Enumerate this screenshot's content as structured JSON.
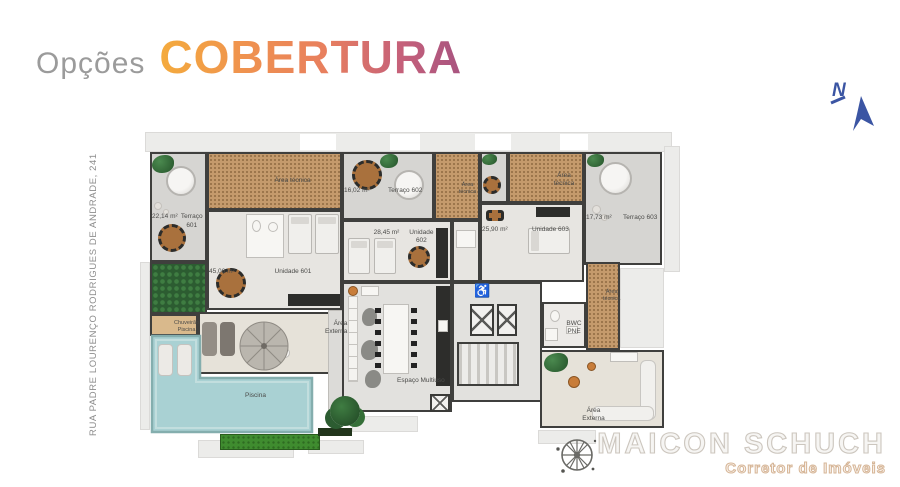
{
  "header": {
    "prefix": "Opções",
    "title": "COBERTURA"
  },
  "address": "RUA PADRE LOURENÇO RODRIGUES DE ANDRADE, 241",
  "compass": {
    "label": "N"
  },
  "branding": {
    "name": "MAICON SCHUCH",
    "tagline": "Corretor de Imóveis"
  },
  "icons": {
    "wheelchair": "♿"
  },
  "colors": {
    "title_gradient_start": "#f4ab3d",
    "title_gradient_end": "#a85480",
    "prefix_gray": "#9b9b9b",
    "compass_blue": "#3b55a3",
    "technical_floor": "#c49a6c",
    "terrace_floor": "#d6d5d2",
    "unit_floor": "#e7e5e1",
    "pool_water": "#a9d1d3",
    "grass_green": "#3f8c2f",
    "wall": "#3f3f3d"
  },
  "plan": {
    "rooms": [
      {
        "id": "terraco-601",
        "name": "Terraço 601",
        "area": "22,14 m²"
      },
      {
        "id": "area-tecnica-1",
        "name": "Área técnica"
      },
      {
        "id": "terraco-602",
        "name": "Terraço 602",
        "area": "16,02 m²"
      },
      {
        "id": "area-tecnica-2",
        "name": "Área técnica"
      },
      {
        "id": "area-tecnica-3",
        "name": "Área técnica"
      },
      {
        "id": "terraco-603",
        "name": "Terraço 603",
        "area": "17,73 m²"
      },
      {
        "id": "unidade-601",
        "name": "Unidade 601",
        "area": "45,06 m²"
      },
      {
        "id": "unidade-602",
        "name": "Unidade 602",
        "area": "28,45 m²"
      },
      {
        "id": "unidade-603",
        "name": "Unidade 603",
        "area": "25,90 m²"
      },
      {
        "id": "chuveirao-piscina",
        "name": "Chuveirão Piscina"
      },
      {
        "id": "piscina",
        "name": "Piscina"
      },
      {
        "id": "area-externa-1",
        "name": "Área Externa"
      },
      {
        "id": "espaco-multiuso",
        "name": "Espaço Multiuso"
      },
      {
        "id": "bwc-pne",
        "name": "BWC PNE"
      },
      {
        "id": "area-tecnica-4",
        "name": "Área técnica"
      },
      {
        "id": "area-externa-2",
        "name": "Área Externa"
      }
    ]
  }
}
